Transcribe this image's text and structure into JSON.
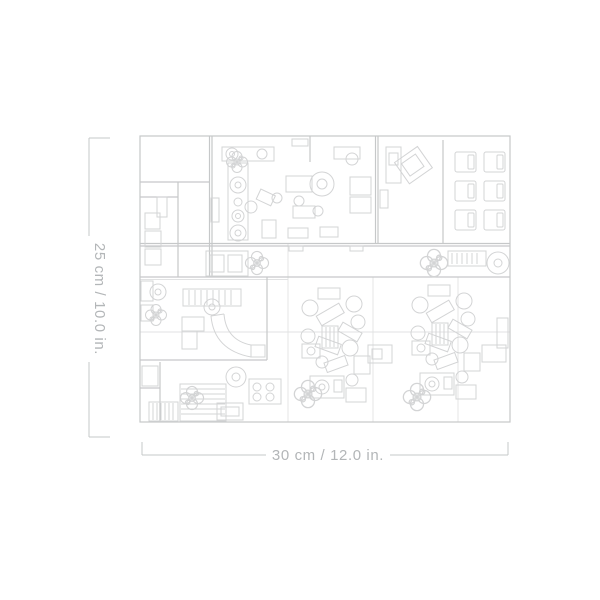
{
  "diagram": {
    "kind": "top-down floor-plan line drawing with product dimensions",
    "height_label": "25 cm / 10.0 in.",
    "width_label": "30 cm / 12.0 in.",
    "colors": {
      "background": "#ffffff",
      "wall_line": "#c6c8c9",
      "furniture_line": "#d3d4d5",
      "seam_line": "#e1e2e3",
      "dimension_line": "#c6c8c9",
      "label_text": "#b3b6b8"
    }
  }
}
